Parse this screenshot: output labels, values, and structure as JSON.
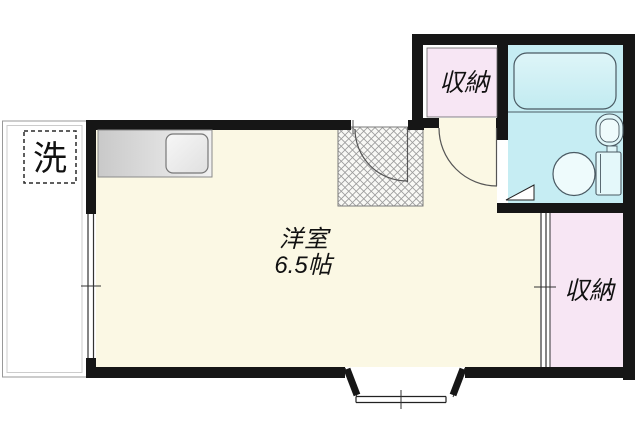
{
  "floorplan": {
    "labels": {
      "room_name": "洋室",
      "room_size": "6.5帖",
      "closet_top": "収納",
      "closet_right": "収納",
      "washer": "洗"
    },
    "colors": {
      "wall": "#161616",
      "room_floor": "#FBF8E4",
      "closet_floor": "#F7E6F4",
      "bathroom_floor": "#C6EDF3",
      "fixture_line": "#4a5a63",
      "outside": "#FFFFFF"
    }
  }
}
